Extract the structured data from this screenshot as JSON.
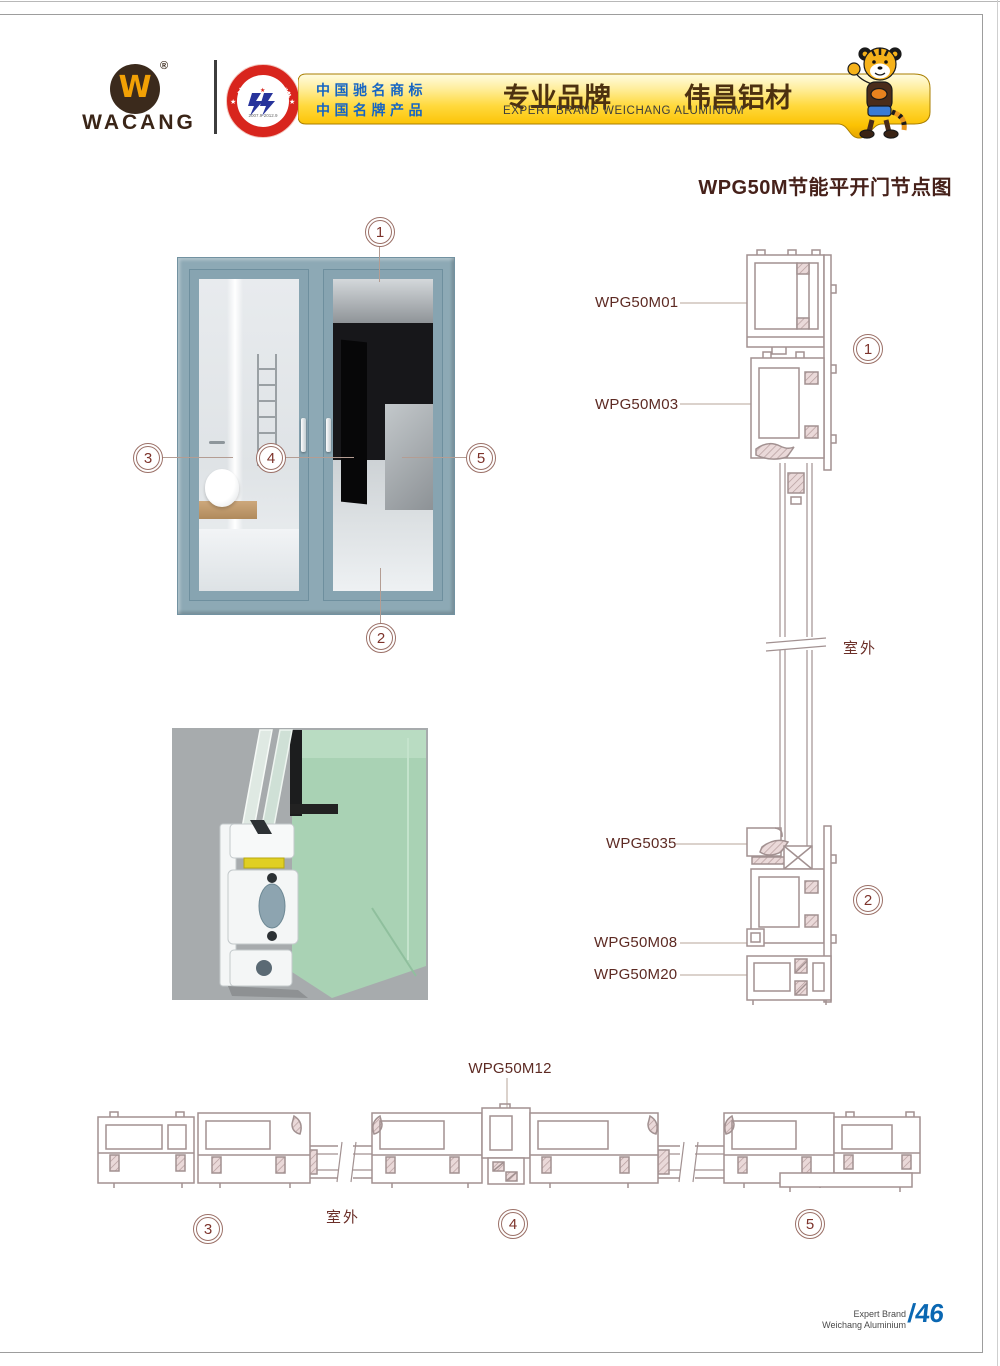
{
  "header": {
    "brand": "WACANG",
    "logo_w": "W",
    "registered": "®",
    "badge_top": "中国名牌",
    "badge_bottom": "CHINA TOP BRAND",
    "badge_dates": "2007.9-2012.9",
    "claim_line1": "中国驰名商标",
    "claim_line2": "中国名牌产品",
    "banner_cn_left": "专业品牌",
    "banner_cn_right": "伟昌铝材",
    "banner_en": "EXPERT BRAND WEICHANG ALUMINIUM"
  },
  "title": "WPG50M节能平开门节点图",
  "elevation": {
    "callout1": "1",
    "callout2": "2",
    "callout3": "3",
    "callout4": "4",
    "callout5": "5"
  },
  "vertical_section": {
    "label_top1": "WPG50M01",
    "label_top2": "WPG50M03",
    "outdoor": "室外",
    "label_bottom1": "WPG5035",
    "label_bottom2": "WPG50M08",
    "label_bottom3": "WPG50M20",
    "circle1": "1",
    "circle2": "2"
  },
  "horizontal_section": {
    "label": "WPG50M12",
    "outdoor": "室外",
    "circle3": "3",
    "circle4": "4",
    "circle5": "5"
  },
  "footer": {
    "line1": "Expert Brand",
    "line2": "Weichang Aluminium",
    "page": "/46"
  },
  "colors": {
    "banner_gold": "#ffd200",
    "label_maroon": "#5d2a23",
    "claim_blue": "#1565c4",
    "page_blue": "#0a67b2",
    "door_frame": "#8da9b5",
    "drawing_stroke": "#a29191"
  }
}
